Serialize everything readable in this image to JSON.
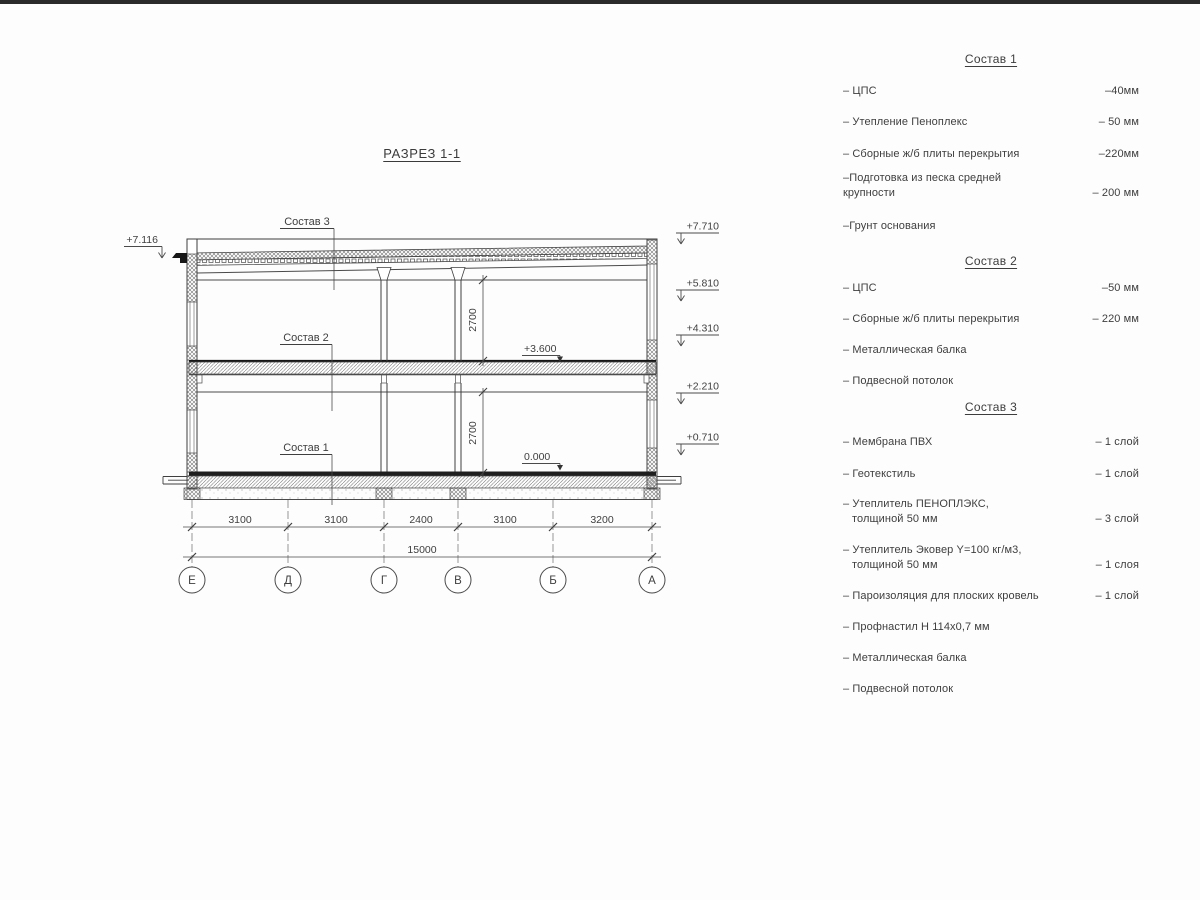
{
  "title": "РАЗРЕЗ 1-1",
  "drawing": {
    "labels": {
      "sostav3": "Состав 3",
      "sostav2": "Состав 2",
      "sostav1": "Состав 1"
    },
    "elevation_left": "+7.116",
    "elevations_right": [
      "+7.710",
      "+5.810",
      "+4.310",
      "+2.210",
      "+0.710"
    ],
    "elevation_floor2": "+3.600",
    "elevation_floor1": "0.000",
    "dim_height_upper": "2700",
    "dim_height_lower": "2700",
    "dim_segments": [
      "3100",
      "3100",
      "2400",
      "3100",
      "3200"
    ],
    "dim_total": "15000",
    "grid_axes": [
      "Е",
      "Д",
      "Г",
      "В",
      "Б",
      "А"
    ]
  },
  "legend": {
    "sections": [
      {
        "heading": "Состав 1",
        "items": [
          {
            "label": "– ЦПС",
            "value": "–40мм"
          },
          {
            "label": "– Утепление Пеноплекс",
            "value": "– 50 мм"
          },
          {
            "label": "– Сборные ж/б плиты перекрытия",
            "value": "–220мм"
          },
          {
            "label": "–Подготовка из песка средней",
            "label2": "крупности",
            "value": "– 200 мм"
          },
          {
            "label": "–Грунт основания",
            "value": ""
          }
        ]
      },
      {
        "heading": "Состав 2",
        "items": [
          {
            "label": "– ЦПС",
            "value": "–50 мм"
          },
          {
            "label": "– Сборные ж/б плиты перекрытия",
            "value": "– 220 мм"
          },
          {
            "label": "– Металлическая балка",
            "value": ""
          },
          {
            "label": "– Подвесной потолок",
            "value": ""
          }
        ]
      },
      {
        "heading": "Состав 3",
        "items": [
          {
            "label": "– Мембрана ПВХ",
            "value": "– 1 слой"
          },
          {
            "label": "– Геотекстиль",
            "value": "– 1 слой"
          },
          {
            "label": "– Утеплитель ПЕНОПЛЭКС,",
            "label2": "толщиной 50 мм",
            "value": "– 3 слой"
          },
          {
            "label": "– Утеплитель Эковер Y=100 кг/м3,",
            "label2": "толщиной 50 мм",
            "value": "– 1 слоя"
          },
          {
            "label": "– Пароизоляция для плоских кровель",
            "value": "– 1 слой"
          },
          {
            "label": "– Профнастил Н 114х0,7 мм",
            "value": ""
          },
          {
            "label": "– Металлическая балка",
            "value": ""
          },
          {
            "label": "– Подвесной потолок",
            "value": ""
          }
        ]
      }
    ]
  }
}
